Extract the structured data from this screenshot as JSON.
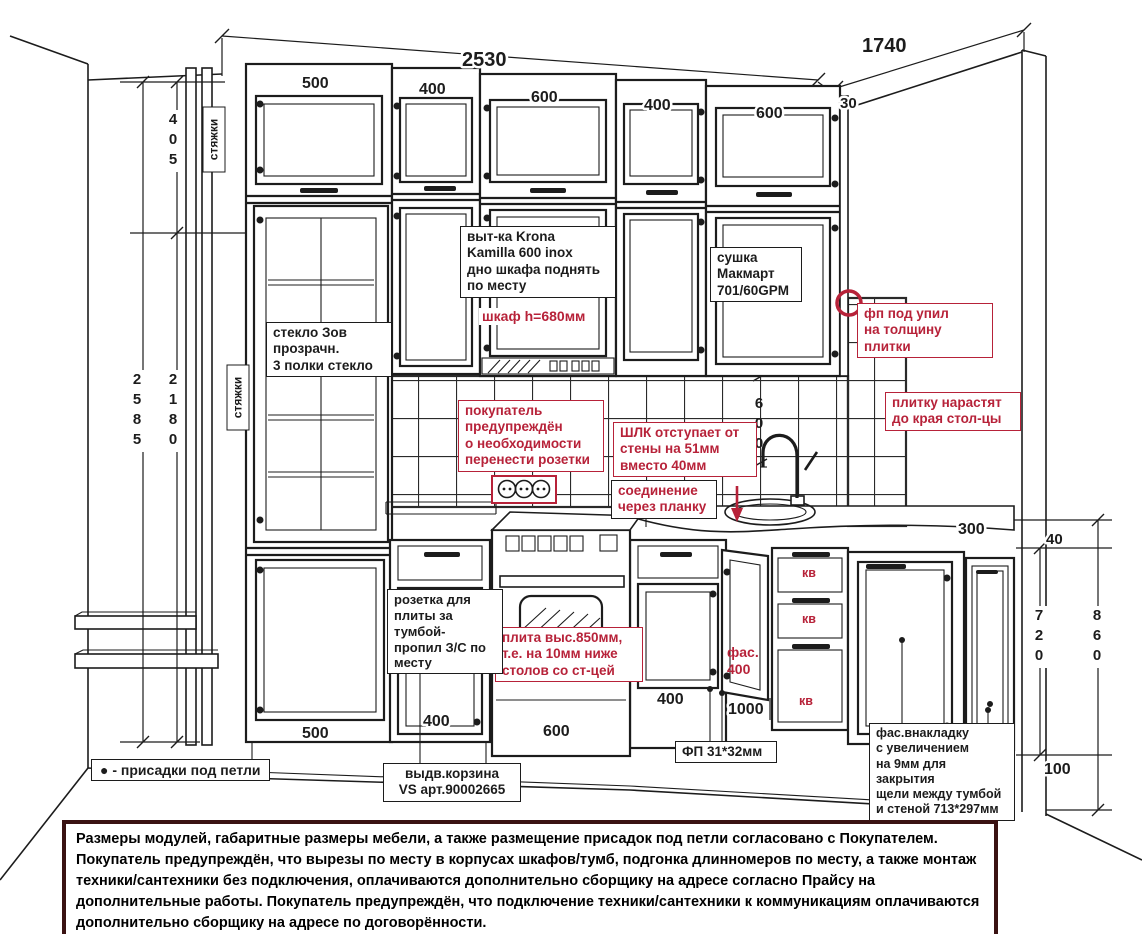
{
  "colors": {
    "annotation_red": "#b72239",
    "ink": "#1c1c1c",
    "footer_border": "#3a1212"
  },
  "dims": {
    "total_width": "2530",
    "return_width": "1740",
    "filler": "30",
    "upper": [
      "500",
      "400",
      "600",
      "400",
      "600"
    ],
    "base": [
      "500",
      "400",
      "600",
      "400"
    ],
    "door_top_height": "405",
    "height_total": "2585",
    "height_upper": "2180",
    "splash_height": "600",
    "base_height": "720",
    "base_total_height": "860",
    "plinth_height": "100",
    "counter_thickness": "40",
    "return_depth": "300",
    "corner_width": "1000",
    "wall_gap": "20"
  },
  "notes": {
    "ties": "стяжки",
    "glass": "стекло Зов\nпрозрачн.\n3 полки стекло",
    "hood": "выт-ка Krona\nKamilla 600 inox\nдно шкафа поднять\nпо месту",
    "hood_height": "шкаф h=680мм",
    "dryer": "сушка\nМакмарт\n701/60GPM",
    "fp_cut": "фп под упил\nна толщину\nплитки",
    "tile_extend": "плитку нарастят\nдо края стол-цы",
    "outlets_warn": "покупатель\nпредупреждён\nо необходимости\nперенести розетки",
    "shlk": "ШЛК отступает от\nстены на 51мм\nвместо 40мм",
    "joint": "соединение\nчерез планку",
    "stove": "плита выс.850мм,\nт.е. на 10мм ниже\nстолов со ст-цей",
    "stove_socket": "розетка для\nплиты за тумбой-\nпропил З/С по\nместу",
    "facade": "фас.\n400",
    "drawer_type": "кв",
    "fp": "ФП 31*32мм",
    "facade_insert": "фас.внакладку\nс увеличением\nна 9мм для закрытия\nщели между тумбой\nи стеной 713*297мм",
    "basket": "выдв.корзина\nVS арт.90002665"
  },
  "legend": {
    "dot": "●",
    "text": "- присадки под петли"
  },
  "footer": "Размеры модулей, габаритные размеры мебели, а также размещение присадок под петли согласовано с Покупателем. Покупатель предупреждён, что вырезы по месту в корпусах шкафов/тумб, подгонка длинномеров по месту, а также монтаж техники/сантехники без подключения, оплачиваются дополнительно сборщику на адресе согласно Прайсу на дополнительные работы. Покупатель предупреждён, что подключение техники/сантехники к коммуникациям оплачиваются дополнительно сборщику на адресе по договорённости."
}
